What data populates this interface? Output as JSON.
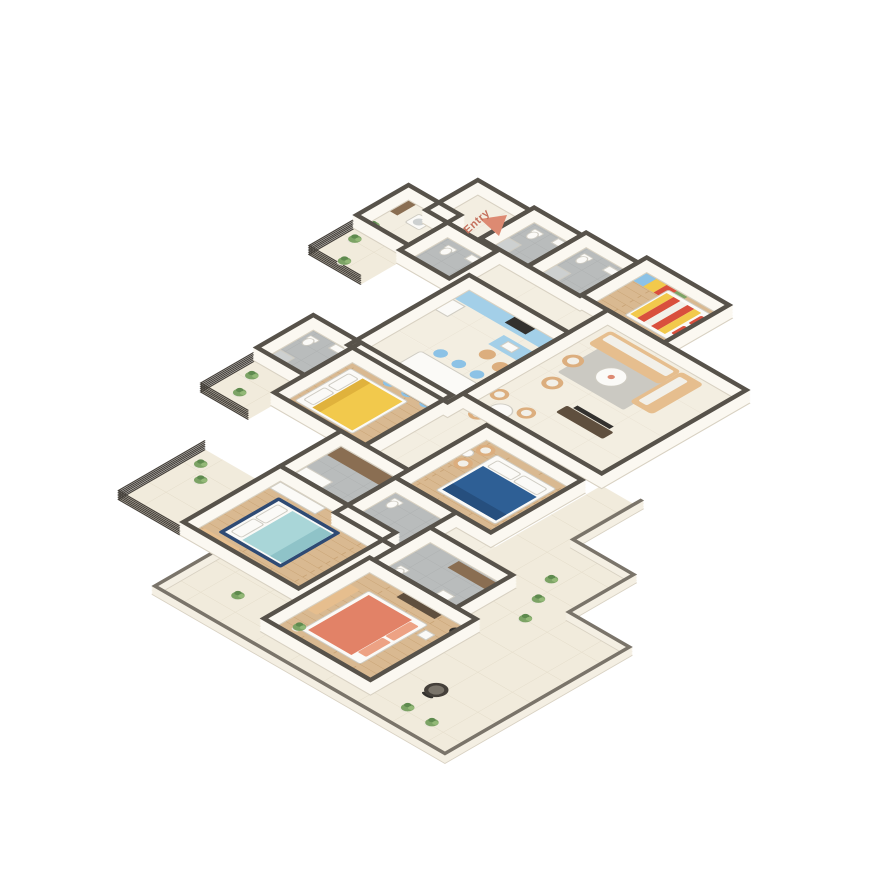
{
  "scene": {
    "description": "Isometric 3D rendered apartment floor plan, dollhouse cutaway view, on plain white background",
    "background": "#ffffff"
  },
  "entry_marker": {
    "label": "Entry"
  },
  "palette": {
    "bg": "#ffffff",
    "wallTop": "#57524a",
    "wallFace": "#fbf8f1",
    "wallBase": "#d8d1c2",
    "parapetFace": "#f4efe3",
    "parapetTop": "#7a746a",
    "railing": "#45403a",
    "creamBase": "#f3eee1",
    "creamLine": "#e7dfcf",
    "woodBase": "#d9b991",
    "woodLine": "#c8a273",
    "tileBase": "#b9bcbc",
    "tileLine": "#aaadad",
    "terraceBase": "#f1ebdc",
    "terraceLine": "#e3dbc8",
    "tileLight": "#cdd0d0",
    "white": "#fbfaf7",
    "grayStroke": "#cfccc3",
    "kitchenBlue": "#a3cfe8",
    "chairBlue": "#8cc2e6",
    "sofaTan": "#e6be8e",
    "wicker": "#dcae7e",
    "cushion": "#f2f0e9",
    "rug": "#cbc9c2",
    "rugDark": "#b9b7af",
    "yellow": "#f2c94c",
    "yellowDark": "#e0b23c",
    "navy": "#2e5f95",
    "navyDark": "#264f7e",
    "navyFrame": "#2e4a74",
    "lightblue": "#a9d6d8",
    "lightblueDark": "#8fc3c8",
    "orange": "#e28267",
    "salmonPillow": "#eda284",
    "red": "#d94f3d",
    "green": "#7ca365",
    "greenDark": "#5e8a4e",
    "greenLight": "#93b977",
    "pot": "#e9e5da",
    "brown": "#8a6e52",
    "brownDark": "#5f4f3e",
    "tvDark": "#33312e",
    "arrow": "#dd8a72",
    "arrowText": "#c4705c"
  },
  "rooms": [
    {
      "id": "entry-foyer",
      "floor": "cream"
    },
    {
      "id": "corridor",
      "floor": "cream"
    },
    {
      "id": "laundry",
      "floor": "cream"
    },
    {
      "id": "bathroom-1",
      "floor": "tile"
    },
    {
      "id": "bathroom-2",
      "floor": "tile"
    },
    {
      "id": "bathroom-3",
      "floor": "tile"
    },
    {
      "id": "kids-bedroom",
      "floor": "wood"
    },
    {
      "id": "kitchen",
      "floor": "cream"
    },
    {
      "id": "dining-area",
      "floor": "cream"
    },
    {
      "id": "living-room",
      "floor": "cream"
    },
    {
      "id": "family-lounge",
      "floor": "cream"
    },
    {
      "id": "hallway",
      "floor": "cream"
    },
    {
      "id": "bedroom-yellow",
      "floor": "wood"
    },
    {
      "id": "ensuite-yellow",
      "floor": "tile"
    },
    {
      "id": "dressing-hall",
      "floor": "tile"
    },
    {
      "id": "master-bedroom",
      "floor": "wood"
    },
    {
      "id": "master-bathroom",
      "floor": "tile"
    },
    {
      "id": "dressing-bathroom",
      "floor": "tile"
    },
    {
      "id": "bedroom-lightblue",
      "floor": "wood"
    },
    {
      "id": "bedroom-orange",
      "floor": "wood"
    },
    {
      "id": "terrace",
      "floor": "terrace"
    },
    {
      "id": "walkway",
      "floor": "terrace"
    },
    {
      "id": "balcony-nw",
      "floor": "terrace"
    },
    {
      "id": "balcony-west",
      "floor": "terrace"
    },
    {
      "id": "balcony-sw",
      "floor": "terrace"
    }
  ],
  "furniture_legend": [
    "kids-bed",
    "colorful-wardrobe",
    "bed-yellow",
    "bed-navy",
    "bed-lightblue",
    "bed-orange",
    "sofa",
    "armchair",
    "lounge-chair",
    "coffee-table",
    "tv",
    "tv-console",
    "living-rug",
    "dining-table",
    "dining-chair",
    "bar-stool",
    "kitchen-counter",
    "kitchen-bar-counter",
    "fridge",
    "cooktop",
    "sink",
    "toilet",
    "shower",
    "vanity",
    "washing-machine",
    "wardrobe",
    "dresser",
    "bench",
    "side-table",
    "potted-plant",
    "hanging-egg-chair",
    "floor-lamp",
    "balcony-railing",
    "terrace-parapet"
  ]
}
